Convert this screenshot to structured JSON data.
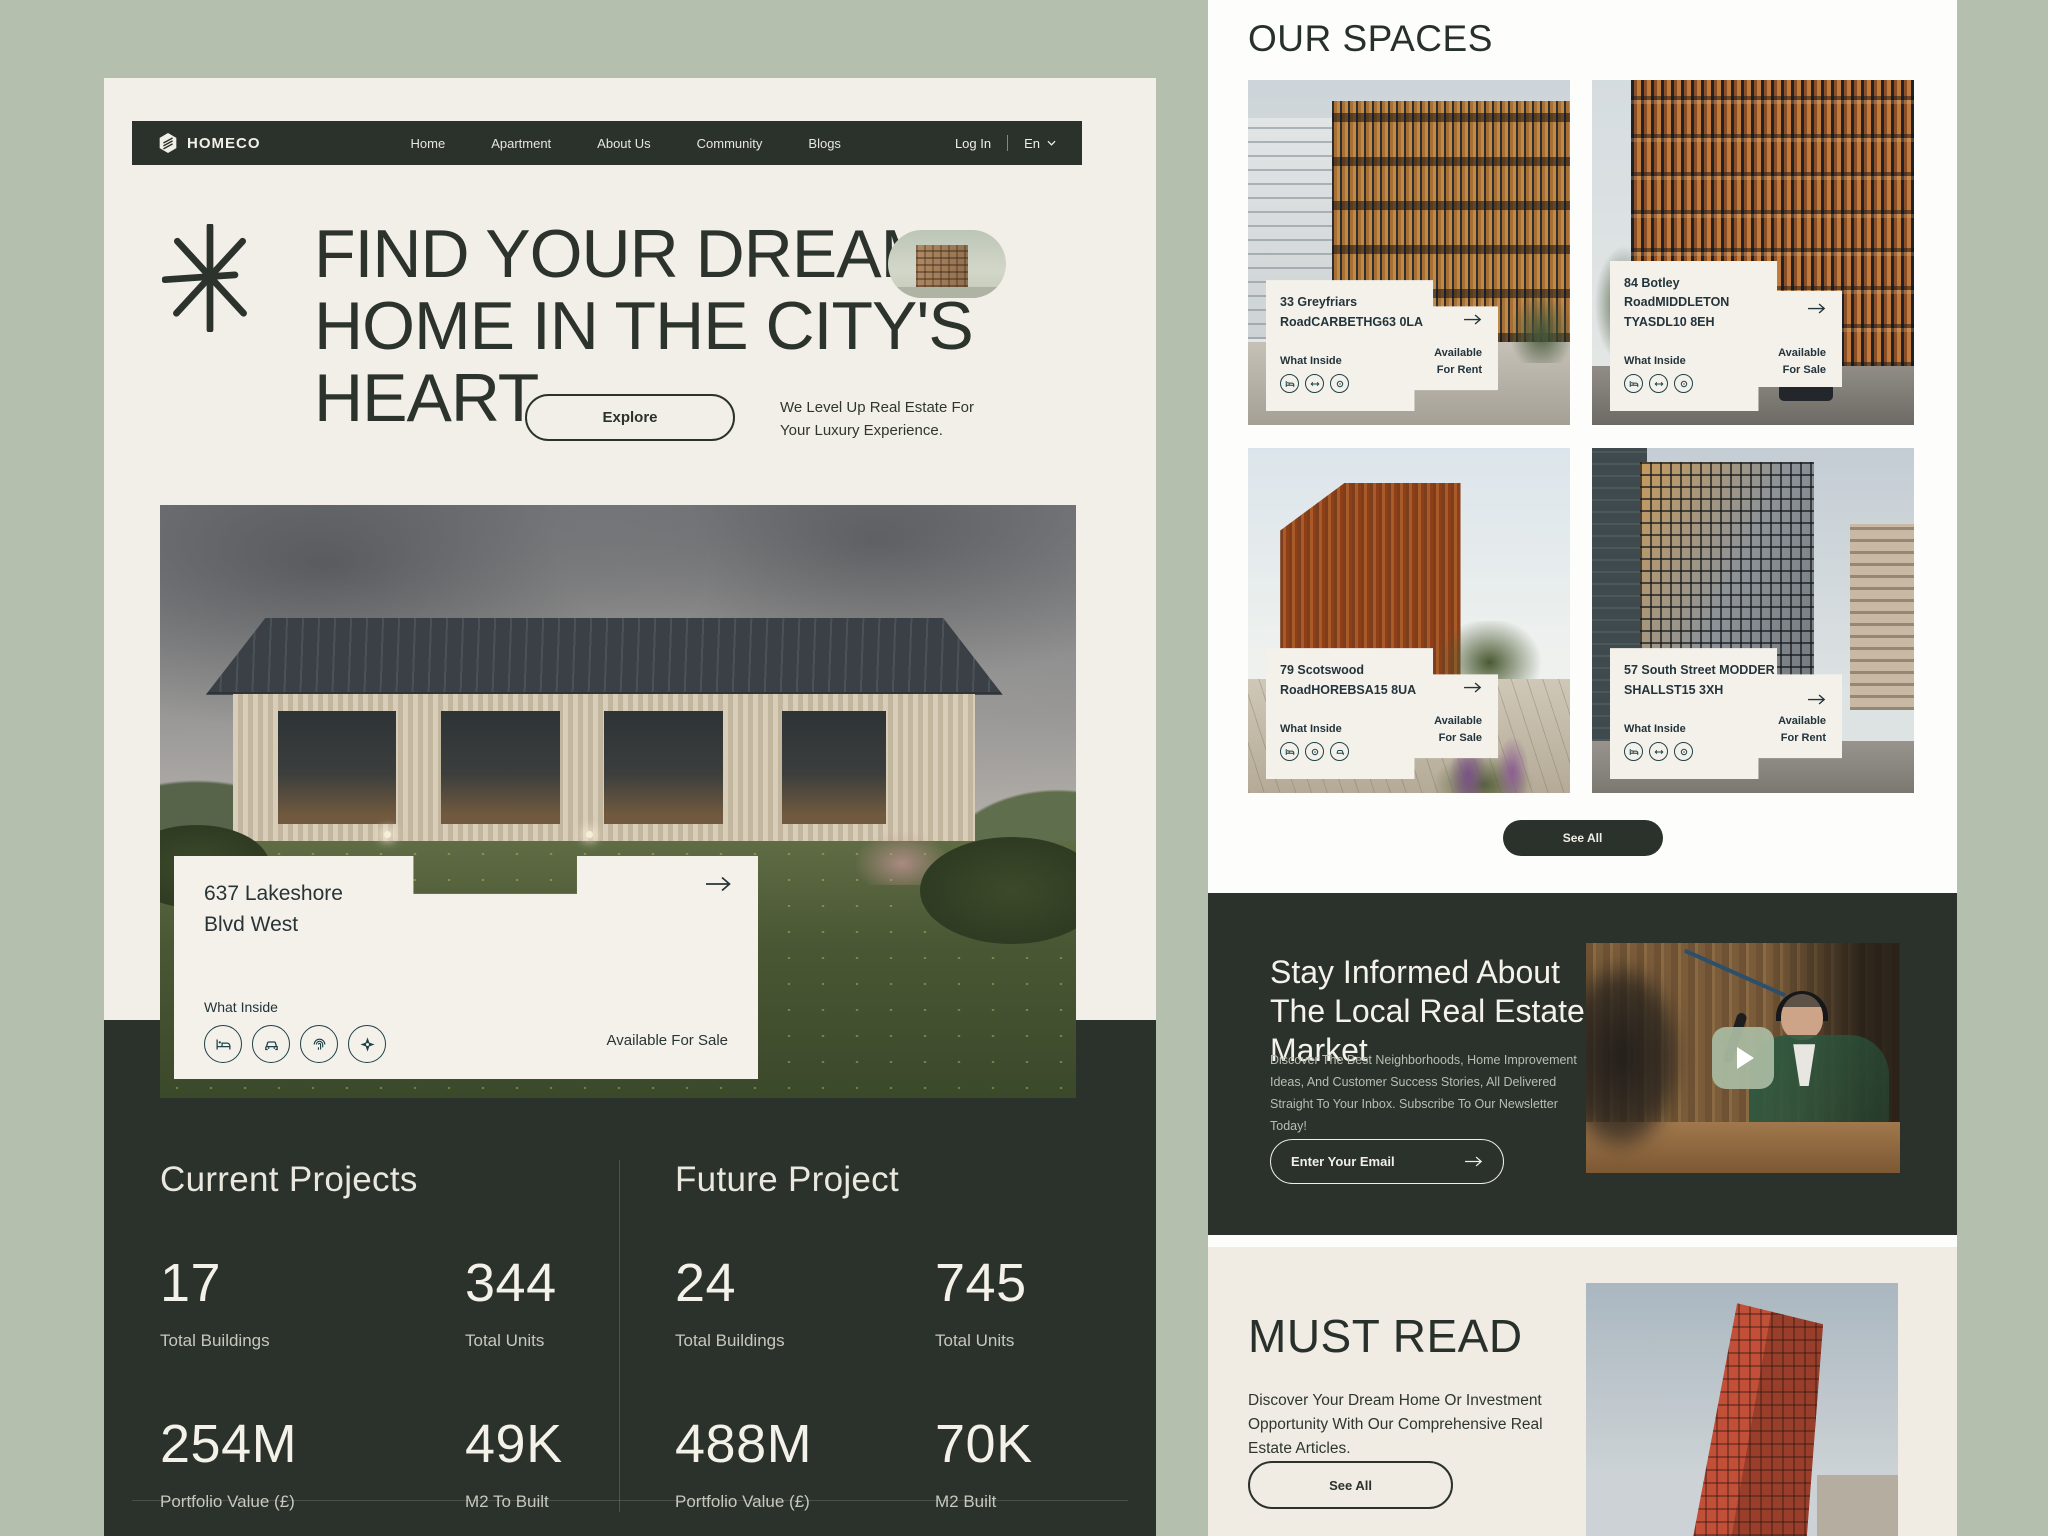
{
  "colors": {
    "sage_background": "#b5bfae",
    "cream_page": "#f2efe8",
    "dark_green": "#2a322b",
    "white_panel": "#fdfdfb",
    "overlay_card": "#f4f1ea",
    "icon_teal": "#1d4249",
    "must_read_bg": "#f0ece3",
    "play_button": "#a8b89f"
  },
  "brand": {
    "name": "HOMECO",
    "logo_icon": "hexagon-house-icon"
  },
  "nav": {
    "links": [
      "Home",
      "Apartment",
      "About Us",
      "Community",
      "Blogs"
    ],
    "login_label": "Log In",
    "language": "En",
    "language_chevron_icon": "chevron-down-icon"
  },
  "hero": {
    "decoration_icon": "asterisk-star-icon",
    "title_lines": [
      "FIND YOUR DREAM",
      "HOME IN THE CITY'S",
      "HEART"
    ],
    "thumbnail": "building-photo-pill",
    "explore_label": "Explore",
    "tagline": "We Level Up Real Estate For Your Luxury Experience."
  },
  "featured_property": {
    "address": "637 Lakeshore Blvd West",
    "what_inside_label": "What Inside",
    "amenity_icons": [
      "bed-icon",
      "car-icon",
      "fingerprint-icon",
      "compass-icon"
    ],
    "availability": "Available For Sale",
    "action_icon": "arrow-right-icon"
  },
  "stats": {
    "current": {
      "title": "Current Projects",
      "items": [
        {
          "value": "17",
          "label": "Total Buildings"
        },
        {
          "value": "344",
          "label": "Total Units"
        },
        {
          "value": "254M",
          "label": "Portfolio Value (£)"
        },
        {
          "value": "49K",
          "label": "M2 To Built"
        }
      ]
    },
    "future": {
      "title": "Future Project",
      "items": [
        {
          "value": "24",
          "label": "Total Buildings"
        },
        {
          "value": "745",
          "label": "Total Units"
        },
        {
          "value": "488M",
          "label": "Portfolio Value (£)"
        },
        {
          "value": "70K",
          "label": "M2 Built"
        }
      ]
    }
  },
  "spaces": {
    "title": "OUR SPACES",
    "what_inside_label": "What Inside",
    "see_all_label": "See All",
    "cards": [
      {
        "address": "33 Greyfriars RoadCARBETHG63 0LA",
        "availability": "Available For Rent",
        "amenity_icons": [
          "bed-icon",
          "arrows-icon",
          "gear-icon"
        ]
      },
      {
        "address": "84 Botley RoadMIDDLETON TYASDL10 8EH",
        "availability": "Available For Sale",
        "amenity_icons": [
          "bed-icon",
          "arrows-icon",
          "gear-icon"
        ]
      },
      {
        "address": "79 Scotswood RoadHOREBSA15 8UA",
        "availability": "Available For Sale",
        "amenity_icons": [
          "bed-icon",
          "gear-icon",
          "car-icon"
        ]
      },
      {
        "address": "57 South Street MODDER SHALLST15 3XH",
        "availability": "Available For Rent",
        "amenity_icons": [
          "bed-icon",
          "arrows-icon",
          "gear-icon"
        ]
      }
    ]
  },
  "newsletter": {
    "title": "Stay Informed About The Local Real Estate Market",
    "body": "Discover The Best Neighborhoods, Home Improvement Ideas, And Customer Success Stories, All Delivered Straight To Your Inbox. Subscribe To Our Newsletter Today!",
    "email_placeholder": "Enter Your Email",
    "submit_icon": "arrow-right-icon",
    "video": "podcast-video-thumbnail"
  },
  "must_read": {
    "title": "MUST READ",
    "body": "Discover Your Dream Home Or Investment Opportunity With Our Comprehensive Real Estate Articles.",
    "see_all_label": "See All",
    "image": "red-building-photo"
  }
}
